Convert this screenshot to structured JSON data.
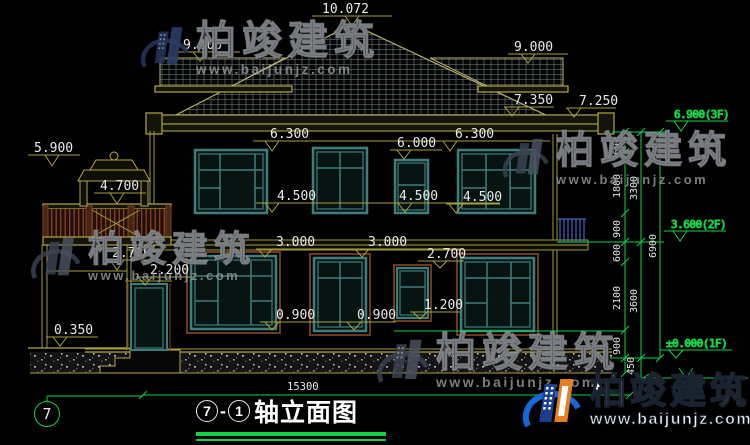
{
  "watermark": {
    "brand": "柏竣建筑",
    "url": "www.baijunjz.com"
  },
  "title_block": {
    "axis_start": "7",
    "separator": "-",
    "axis_end": "1",
    "name": "轴立面图"
  },
  "axis_bubble": "7",
  "dims": {
    "total_width": "15300",
    "peak": "10.072",
    "ridge_left": "9.000",
    "ridge_right": "9.000",
    "eave_main": "7.350",
    "eave_right": "7.250",
    "finial": "5.900",
    "railing_top": "4.700",
    "lintel2f_left": "6.300",
    "lintel2f_right": "6.300",
    "lintel2f_small": "6.000",
    "sill2f_a": "4.500",
    "sill2f_b": "4.500",
    "sill2f_c": "4.500",
    "lintel1f_a": "3.000",
    "lintel1f_b": "3.000",
    "porch_ceiling": "2.700",
    "lintel1f_small": "2.700",
    "door_head": "2.200",
    "sill1f_small": "1.200",
    "sill1f_a": "0.900",
    "sill1f_b": "0.900",
    "porch_floor": "0.350",
    "level_3f": "6.900(3F)",
    "level_2f": "3.600(2F)",
    "level_1f": "±0.000(1F)",
    "v": [
      "600",
      "1800",
      "900",
      "600",
      "2100",
      "900",
      "450",
      "3300",
      "3600",
      "6900"
    ]
  },
  "colors": {
    "axis_green": "#0fd244",
    "dim_olive": "#a7a13d",
    "wm_blue": "#1668d6",
    "wm_orange": "#e67e22"
  }
}
